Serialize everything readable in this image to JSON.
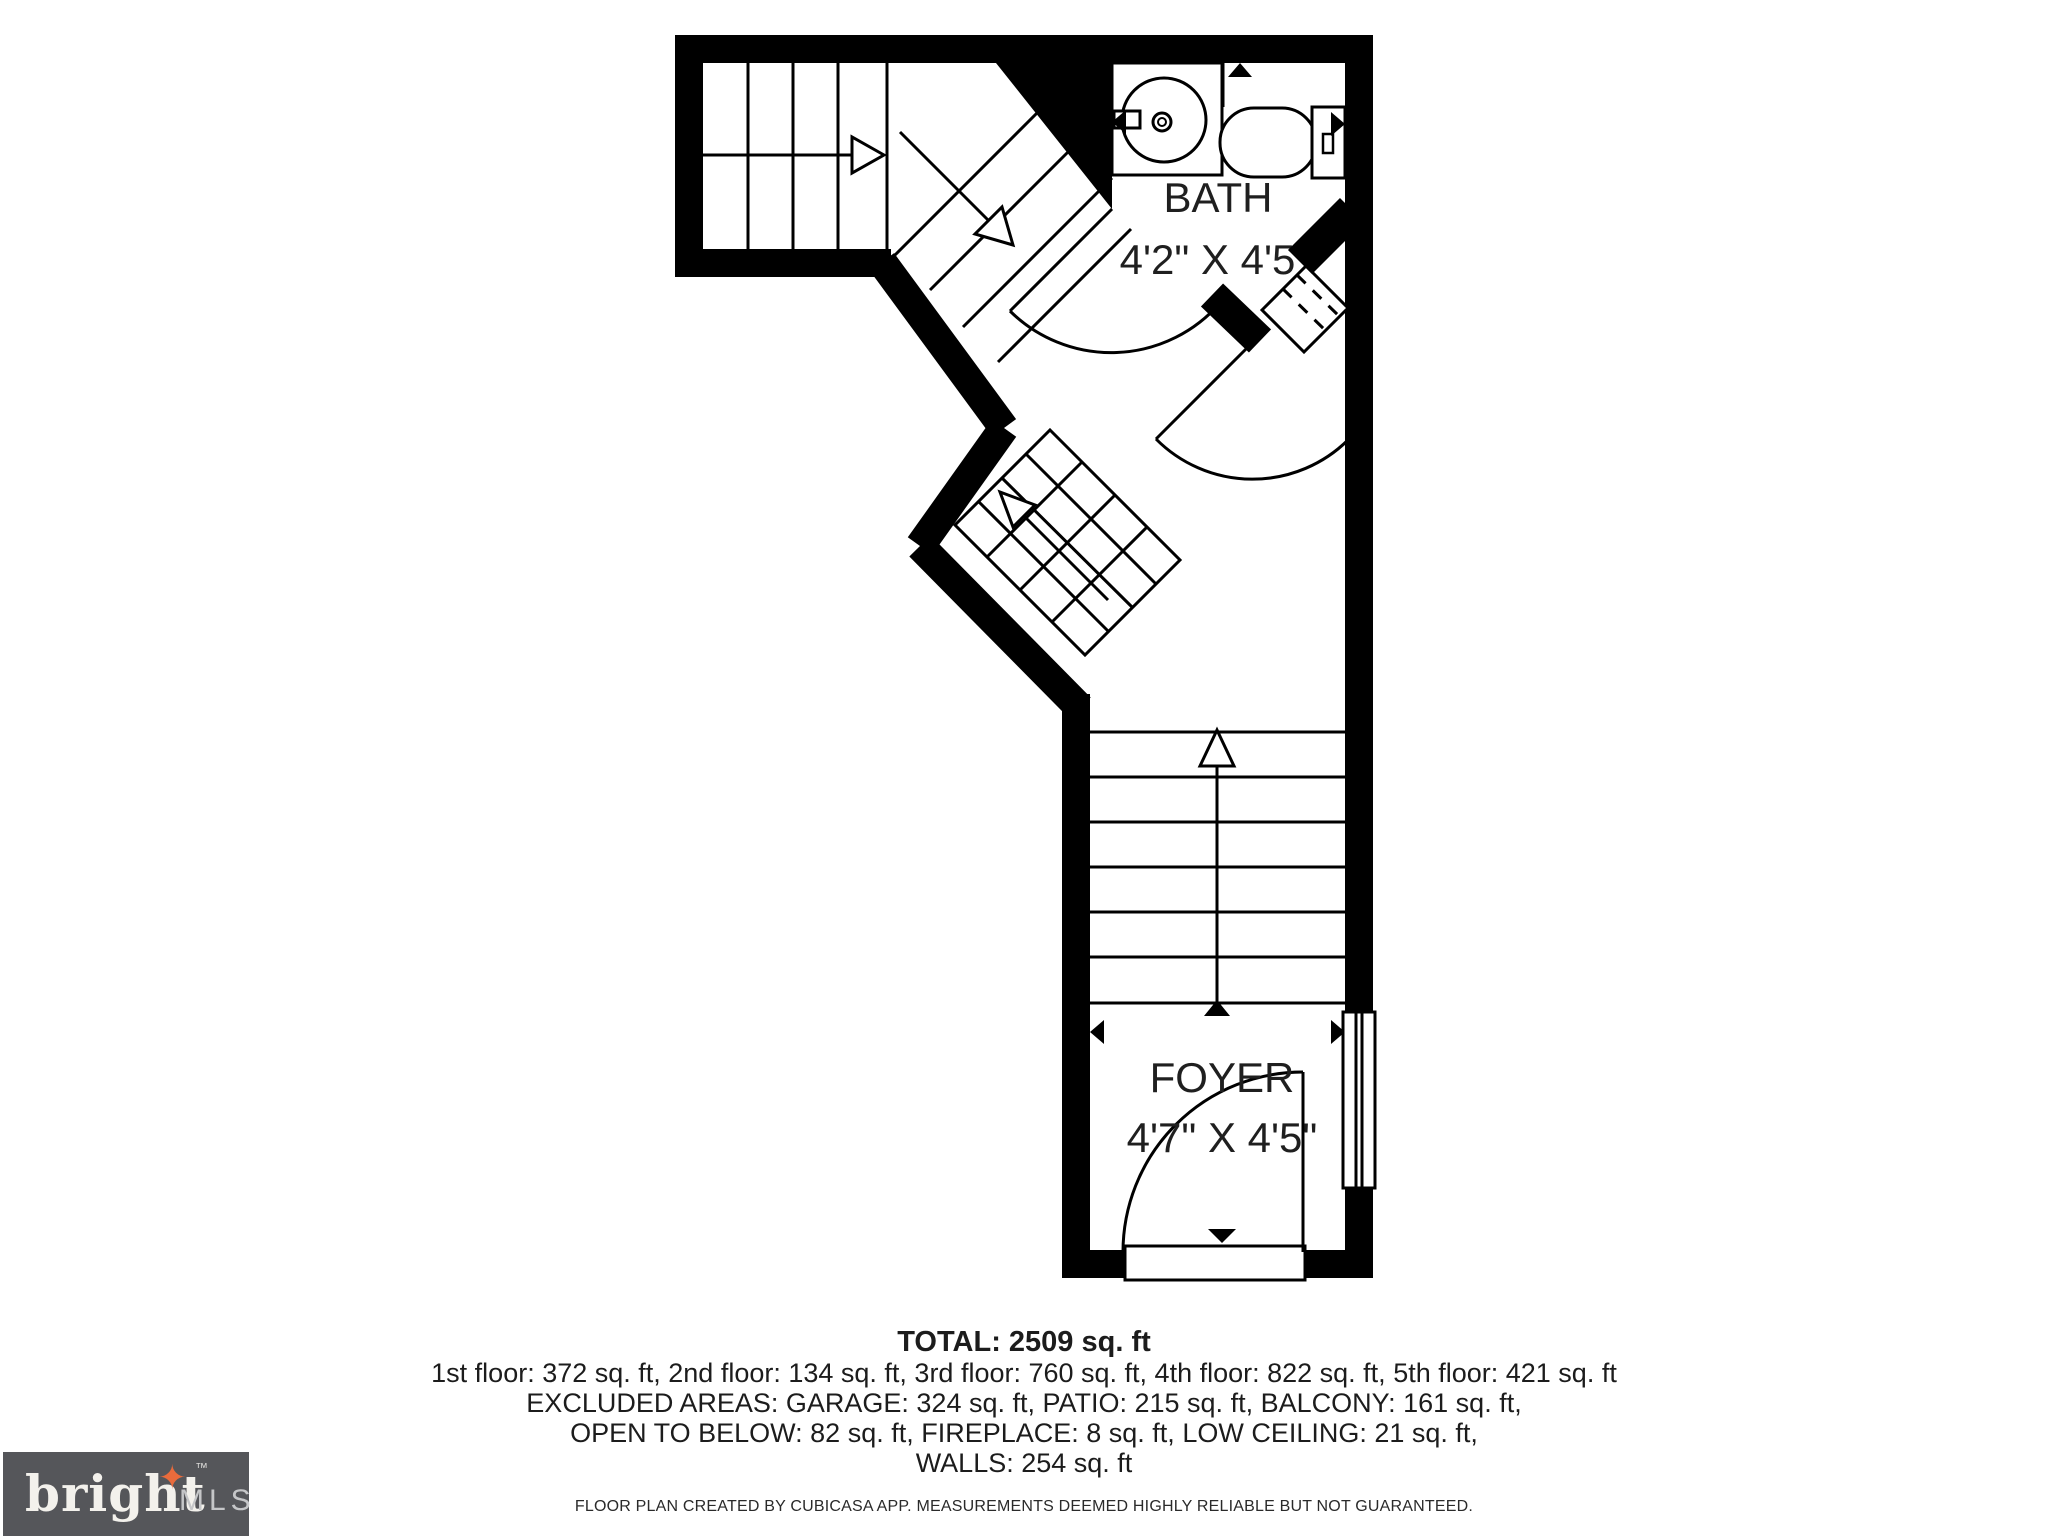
{
  "plan": {
    "ink_color": "#000000",
    "rooms": [
      {
        "name": "BATH",
        "dimensions": "4'2\" X 4'5\""
      },
      {
        "name": "FOYER",
        "dimensions": "4'7\" X 4'5\""
      }
    ]
  },
  "summary": {
    "total": "TOTAL: 2509 sq. ft",
    "floors": "1st floor: 372 sq. ft, 2nd floor: 134 sq. ft, 3rd floor: 760 sq. ft, 4th floor: 822 sq. ft, 5th floor: 421 sq. ft",
    "excluded_line1": "EXCLUDED AREAS: GARAGE: 324 sq. ft, PATIO: 215 sq. ft, BALCONY: 161 sq. ft,",
    "excluded_line2": "OPEN TO BELOW: 82 sq. ft, FIREPLACE: 8 sq. ft, LOW CEILING: 21 sq. ft,",
    "walls": "WALLS: 254 sq. ft",
    "disclaimer": "FLOOR PLAN CREATED BY CUBICASA APP. MEASUREMENTS DEEMED HIGHLY RELIABLE BUT NOT GUARANTEED."
  },
  "logo": {
    "brand": "bright",
    "tm": "™",
    "suffix": "MLS",
    "spark_icon": "✦",
    "colors": {
      "background": "#55565a",
      "brand_text": "#f3f1ec",
      "suffix_text": "#c5c6c8",
      "spark": "#e96b3c"
    }
  }
}
